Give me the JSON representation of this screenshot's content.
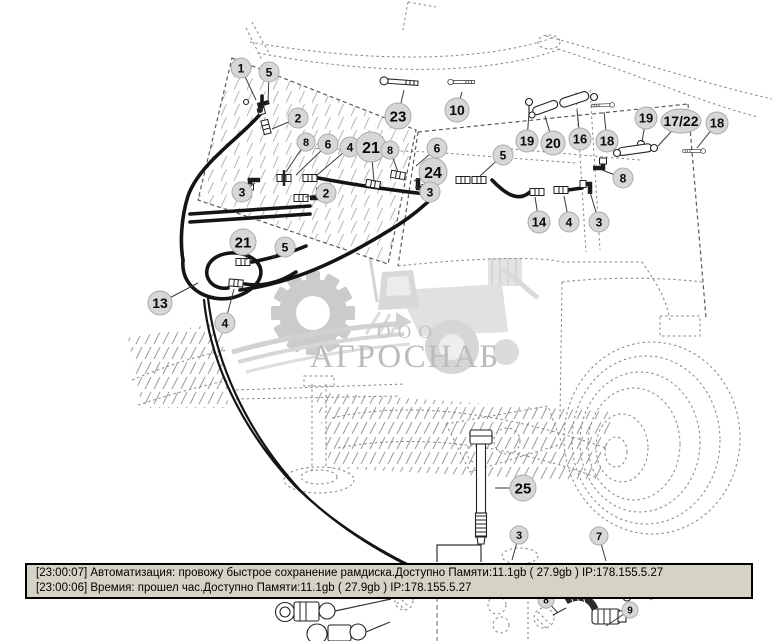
{
  "watermark": {
    "prefix": "ООО",
    "name": "АГРОСНАБ"
  },
  "status_bar": {
    "lines": [
      "[23:00:07]  Автоматизация: провожу быстрое сохранение рамдиска.Доступно Памяти:11.1gb  ( 27.9gb ) IP:178.155.5.27",
      "[23:00:06]  Времия: прошел час.Доступно Памяти:11.1gb  ( 27.9gb ) IP:178.155.5.27"
    ]
  },
  "callouts": [
    {
      "n": "1",
      "x": 241,
      "y": 68,
      "r": 10,
      "lx": 256,
      "ly": 100
    },
    {
      "n": "5",
      "x": 269,
      "y": 72,
      "r": 10,
      "lx": 268,
      "ly": 104
    },
    {
      "n": "2",
      "x": 298,
      "y": 118,
      "r": 10,
      "lx": 272,
      "ly": 129
    },
    {
      "n": "23",
      "x": 398,
      "y": 116,
      "r": 13,
      "lx": 404,
      "ly": 90
    },
    {
      "n": "10",
      "x": 457,
      "y": 110,
      "r": 12,
      "lx": 462,
      "ly": 92
    },
    {
      "n": "8",
      "x": 306,
      "y": 142,
      "r": 9,
      "lx": 286,
      "ly": 172
    },
    {
      "n": "6",
      "x": 328,
      "y": 144,
      "r": 10,
      "lx": 296,
      "ly": 175
    },
    {
      "n": "4",
      "x": 350,
      "y": 147,
      "r": 10,
      "lx": 316,
      "ly": 176
    },
    {
      "n": "21",
      "x": 371,
      "y": 147,
      "r": 15,
      "lx": 374,
      "ly": 182
    },
    {
      "n": "8",
      "x": 390,
      "y": 150,
      "r": 9,
      "lx": 398,
      "ly": 172
    },
    {
      "n": "6",
      "x": 437,
      "y": 148,
      "r": 10,
      "lx": 416,
      "ly": 166
    },
    {
      "n": "19",
      "x": 527,
      "y": 141,
      "r": 11,
      "lx": 529,
      "ly": 112
    },
    {
      "n": "20",
      "x": 553,
      "y": 143,
      "r": 12,
      "lx": 545,
      "ly": 116
    },
    {
      "n": "16",
      "x": 580,
      "y": 139,
      "r": 11,
      "lx": 577,
      "ly": 110
    },
    {
      "n": "18",
      "x": 607,
      "y": 141,
      "r": 11,
      "lx": 604,
      "ly": 112
    },
    {
      "n": "19",
      "x": 646,
      "y": 118,
      "r": 11,
      "lx": 642,
      "ly": 142
    },
    {
      "n": "17/22",
      "x": 681,
      "y": 121,
      "r": 12,
      "wide": true,
      "lx": 658,
      "ly": 146
    },
    {
      "n": "18",
      "x": 717,
      "y": 123,
      "r": 11,
      "lx": 697,
      "ly": 148
    },
    {
      "n": "5",
      "x": 503,
      "y": 155,
      "r": 10,
      "lx": 480,
      "ly": 176
    },
    {
      "n": "24",
      "x": 433,
      "y": 172,
      "r": 14,
      "lx": 414,
      "ly": 181
    },
    {
      "n": "3",
      "x": 430,
      "y": 192,
      "r": 10,
      "lx": 415,
      "ly": 187
    },
    {
      "n": "8",
      "x": 623,
      "y": 178,
      "r": 10,
      "lx": 602,
      "ly": 170
    },
    {
      "n": "3",
      "x": 242,
      "y": 192,
      "r": 10,
      "lx": 255,
      "ly": 183
    },
    {
      "n": "2",
      "x": 326,
      "y": 193,
      "r": 10,
      "lx": 305,
      "ly": 197
    },
    {
      "n": "14",
      "x": 539,
      "y": 222,
      "r": 11,
      "lx": 535,
      "ly": 197
    },
    {
      "n": "4",
      "x": 569,
      "y": 222,
      "r": 10,
      "lx": 564,
      "ly": 196
    },
    {
      "n": "3",
      "x": 599,
      "y": 222,
      "r": 10,
      "lx": 590,
      "ly": 192
    },
    {
      "n": "21",
      "x": 243,
      "y": 242,
      "r": 13,
      "lx": 247,
      "ly": 260
    },
    {
      "n": "5",
      "x": 285,
      "y": 247,
      "r": 10,
      "lx": 272,
      "ly": 258
    },
    {
      "n": "13",
      "x": 160,
      "y": 303,
      "r": 12,
      "lx": 198,
      "ly": 283
    },
    {
      "n": "4",
      "x": 225,
      "y": 323,
      "r": 10,
      "lx": 234,
      "ly": 289
    },
    {
      "n": "25",
      "x": 523,
      "y": 488,
      "r": 13,
      "lx": 495,
      "ly": 488
    },
    {
      "n": "3",
      "x": 519,
      "y": 535,
      "r": 9,
      "lx": 512,
      "ly": 560
    },
    {
      "n": "7",
      "x": 599,
      "y": 536,
      "r": 9,
      "lx": 606,
      "ly": 561
    },
    {
      "n": "8",
      "x": 546,
      "y": 600,
      "r": 8,
      "lx": 558,
      "ly": 613
    },
    {
      "n": "9",
      "x": 630,
      "y": 610,
      "r": 8,
      "lx": 606,
      "ly": 626
    }
  ]
}
